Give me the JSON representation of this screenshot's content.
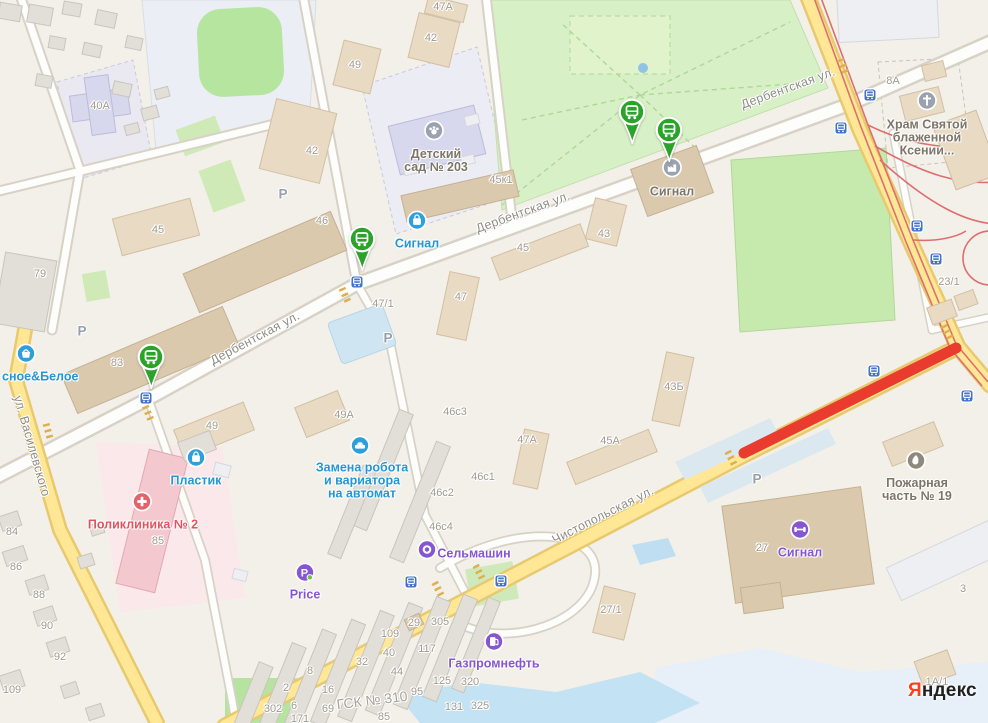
{
  "logo": {
    "first": "Я",
    "rest": "ндекс"
  },
  "palette": {
    "closure_red": "#e93c2e",
    "pin_green": "#2ba32b",
    "transit_blue": "#4472c8",
    "road_yellow": "#ffe795",
    "poi_blue": "#2f9fdc",
    "poi_purple": "#8655d2",
    "poi_red": "#e4626b",
    "poi_grey": "#99a2ae"
  },
  "streets": [
    {
      "label": "Дербентская ул.",
      "x": 255,
      "y": 338,
      "rot": -28
    },
    {
      "label": "Дербентская ул.",
      "x": 523,
      "y": 212,
      "rot": -20
    },
    {
      "label": "Дербентская ул.",
      "x": 788,
      "y": 88,
      "rot": -20
    },
    {
      "label": "Чистопольская ул.",
      "x": 603,
      "y": 515,
      "rot": -27
    },
    {
      "label": "ул. Василевского",
      "x": 32,
      "y": 446,
      "rot": 74
    }
  ],
  "house_numbers": [
    {
      "t": "40А",
      "x": 100,
      "y": 106
    },
    {
      "t": "42",
      "x": 312,
      "y": 151
    },
    {
      "t": "42",
      "x": 431,
      "y": 38
    },
    {
      "t": "47А",
      "x": 443,
      "y": 7
    },
    {
      "t": "49",
      "x": 355,
      "y": 65
    },
    {
      "t": "45",
      "x": 158,
      "y": 230
    },
    {
      "t": "46",
      "x": 322,
      "y": 221
    },
    {
      "t": "79",
      "x": 40,
      "y": 274
    },
    {
      "t": "83",
      "x": 117,
      "y": 363
    },
    {
      "t": "45к1",
      "x": 501,
      "y": 180
    },
    {
      "t": "47/1",
      "x": 383,
      "y": 304
    },
    {
      "t": "47",
      "x": 461,
      "y": 297
    },
    {
      "t": "45",
      "x": 523,
      "y": 248
    },
    {
      "t": "43",
      "x": 604,
      "y": 234
    },
    {
      "t": "8А",
      "x": 893,
      "y": 81
    },
    {
      "t": "23/1",
      "x": 949,
      "y": 282
    },
    {
      "t": "43Б",
      "x": 674,
      "y": 387
    },
    {
      "t": "49",
      "x": 212,
      "y": 426
    },
    {
      "t": "49А",
      "x": 344,
      "y": 415
    },
    {
      "t": "46с3",
      "x": 455,
      "y": 412
    },
    {
      "t": "47А",
      "x": 527,
      "y": 440
    },
    {
      "t": "45А",
      "x": 610,
      "y": 441
    },
    {
      "t": "46с1",
      "x": 483,
      "y": 477
    },
    {
      "t": "46с2",
      "x": 442,
      "y": 493
    },
    {
      "t": "46с4",
      "x": 441,
      "y": 527
    },
    {
      "t": "27/1",
      "x": 611,
      "y": 610
    },
    {
      "t": "27",
      "x": 762,
      "y": 548
    },
    {
      "t": "3",
      "x": 963,
      "y": 589
    },
    {
      "t": "1А/1",
      "x": 937,
      "y": 682
    },
    {
      "t": "84",
      "x": 12,
      "y": 532
    },
    {
      "t": "86",
      "x": 16,
      "y": 567
    },
    {
      "t": "88",
      "x": 39,
      "y": 595
    },
    {
      "t": "90",
      "x": 47,
      "y": 626
    },
    {
      "t": "92",
      "x": 60,
      "y": 657
    },
    {
      "t": "109",
      "x": 12,
      "y": 690
    },
    {
      "t": "85",
      "x": 158,
      "y": 541
    },
    {
      "t": "305",
      "x": 440,
      "y": 622
    },
    {
      "t": "29",
      "x": 414,
      "y": 623
    },
    {
      "t": "109",
      "x": 390,
      "y": 634
    },
    {
      "t": "40",
      "x": 389,
      "y": 653
    },
    {
      "t": "32",
      "x": 362,
      "y": 662
    },
    {
      "t": "44",
      "x": 397,
      "y": 672
    },
    {
      "t": "117",
      "x": 427,
      "y": 649
    },
    {
      "t": "125",
      "x": 442,
      "y": 681
    },
    {
      "t": "320",
      "x": 470,
      "y": 682
    },
    {
      "t": "95",
      "x": 417,
      "y": 692
    },
    {
      "t": "131",
      "x": 454,
      "y": 707
    },
    {
      "t": "325",
      "x": 480,
      "y": 706
    },
    {
      "t": "302",
      "x": 273,
      "y": 709
    },
    {
      "t": "6",
      "x": 294,
      "y": 706
    },
    {
      "t": "2",
      "x": 286,
      "y": 688
    },
    {
      "t": "8",
      "x": 310,
      "y": 671
    },
    {
      "t": "16",
      "x": 328,
      "y": 690
    },
    {
      "t": "69",
      "x": 328,
      "y": 709
    },
    {
      "t": "85",
      "x": 384,
      "y": 717
    },
    {
      "t": "171",
      "x": 300,
      "y": 719
    }
  ],
  "area_label": {
    "t": "ГСК № 310",
    "x": 372,
    "y": 700,
    "rot": -7
  },
  "parking_marks": {
    "symbol": "P",
    "positions": [
      [
        283,
        194
      ],
      [
        82,
        331
      ],
      [
        388,
        338
      ],
      [
        757,
        479
      ]
    ]
  },
  "transit_stops": [
    [
      870,
      95
    ],
    [
      841,
      128
    ],
    [
      917,
      226
    ],
    [
      936,
      259
    ],
    [
      874,
      371
    ],
    [
      967,
      396
    ],
    [
      411,
      582
    ],
    [
      501,
      581
    ],
    [
      357,
      282
    ],
    [
      146,
      398
    ]
  ],
  "bus_pins": [
    [
      632,
      112
    ],
    [
      669,
      130
    ],
    [
      362,
      239
    ],
    [
      151,
      357
    ]
  ],
  "pois": [
    {
      "id": "krasnoe-beloe",
      "icon": "basket",
      "color": "blue",
      "ix": 26,
      "iy": 356,
      "lines": [
        "сное&Белое"
      ],
      "tx": 2,
      "ty": 377,
      "align": "left"
    },
    {
      "id": "detsky-sad-203",
      "icon": "paw",
      "color": "grey",
      "ix": 434,
      "iy": 133,
      "lines": [
        "Детский",
        "сад № 203"
      ],
      "tx": 436,
      "ty": 161
    },
    {
      "id": "signal-shop",
      "icon": "bag",
      "color": "blue",
      "ix": 417,
      "iy": 223,
      "lines": [
        "Сигнал"
      ],
      "tx": 417,
      "ty": 244
    },
    {
      "id": "signal-org",
      "icon": "factory",
      "color": "grey",
      "ix": 672,
      "iy": 170,
      "lines": [
        "Сигнал"
      ],
      "tx": 672,
      "ty": 192
    },
    {
      "id": "hram-svyatoy-ksenii",
      "icon": "cross",
      "color": "grey",
      "ix": 927,
      "iy": 103,
      "lines": [
        "Храм Святой",
        "блаженной",
        "Ксении..."
      ],
      "tx": 927,
      "ty": 138
    },
    {
      "id": "zamena-robota",
      "icon": "car",
      "color": "blue",
      "ix": 360,
      "iy": 448,
      "lines": [
        "Замена робота",
        "и вариатора",
        "на автомат"
      ],
      "tx": 362,
      "ty": 481
    },
    {
      "id": "plastik",
      "icon": "bag",
      "color": "blue",
      "ix": 196,
      "iy": 460,
      "lines": [
        "Пластик"
      ],
      "tx": 196,
      "ty": 481
    },
    {
      "id": "poliklinika-2",
      "icon": "medcross",
      "color": "red",
      "ix": 142,
      "iy": 504,
      "lines": [
        "Поликлиника № 2"
      ],
      "tx": 143,
      "ty": 525
    },
    {
      "id": "price",
      "icon": "pprice",
      "color": "purple",
      "ix": 305,
      "iy": 575,
      "lines": [
        "Price"
      ],
      "tx": 305,
      "ty": 595
    },
    {
      "id": "selmashin",
      "icon": "ring",
      "color": "purple",
      "ix": 427,
      "iy": 552,
      "lines": [
        "Сельмашин"
      ],
      "tx": 474,
      "ty": 554
    },
    {
      "id": "gazpromneft",
      "icon": "fuel",
      "color": "purple",
      "ix": 494,
      "iy": 644,
      "lines": [
        "Газпромнефть"
      ],
      "tx": 494,
      "ty": 664
    },
    {
      "id": "signal-gym",
      "icon": "dumbbell",
      "color": "purple",
      "ix": 800,
      "iy": 532,
      "lines": [
        "Сигнал"
      ],
      "tx": 800,
      "ty": 553
    },
    {
      "id": "pozharnaya-chast-19",
      "icon": "flame",
      "color": "olive",
      "ix": 916,
      "iy": 463,
      "lines": [
        "Пожарная",
        "часть № 19"
      ],
      "tx": 917,
      "ty": 490
    }
  ]
}
